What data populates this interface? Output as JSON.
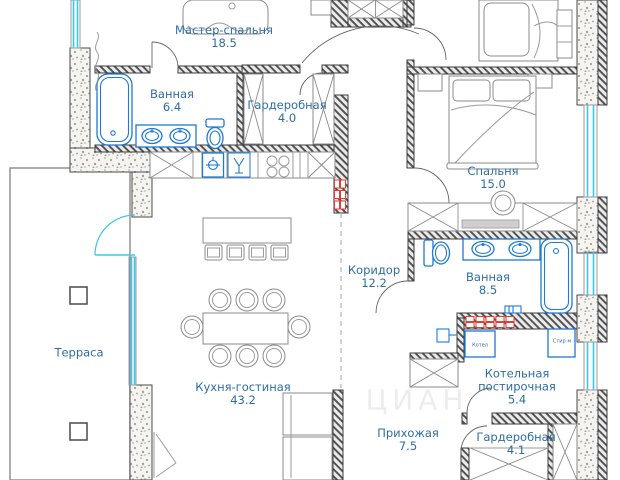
{
  "plan": {
    "rooms": [
      {
        "id": "master-bedroom",
        "name": "Мастер-спальня",
        "area": "18.5"
      },
      {
        "id": "bathroom-1",
        "name": "Ванная",
        "area": "6.4"
      },
      {
        "id": "wardrobe-1",
        "name": "Гардеробная",
        "area": "4.0"
      },
      {
        "id": "bedroom",
        "name": "Спальня",
        "area": "15.0"
      },
      {
        "id": "corridor",
        "name": "Коридор",
        "area": "12.2"
      },
      {
        "id": "bathroom-2",
        "name": "Ванная",
        "area": "8.5"
      },
      {
        "id": "terrace",
        "name": "Терраса",
        "area": ""
      },
      {
        "id": "kitchen-living",
        "name": "Кухня-гостиная",
        "area": "43.2"
      },
      {
        "id": "boiler-laundry",
        "name": "Котельная",
        "name_line2": "постирочная",
        "area": "5.4"
      },
      {
        "id": "hallway",
        "name": "Прихожая",
        "area": "7.5"
      },
      {
        "id": "wardrobe-2",
        "name": "Гардеробная",
        "area": "4.1"
      }
    ],
    "appliance_labels": {
      "boiler": "Котел",
      "washer": "Стир м"
    },
    "watermark": "ЦИАН",
    "colors": {
      "room_label": "#2e6da4",
      "plumbing": "#1e7ad4",
      "glazing": "#3bc6f0",
      "radiator": "#e23d36",
      "wall_dark": "#3d3d3d"
    }
  }
}
